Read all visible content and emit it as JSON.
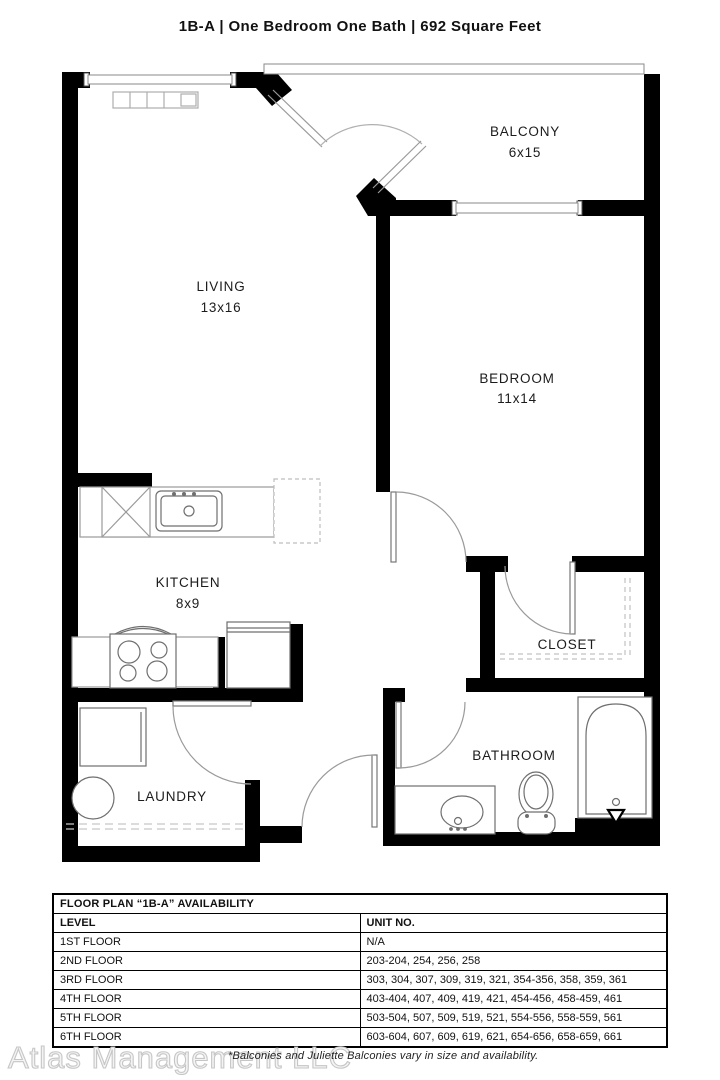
{
  "title": "1B-A  | One Bedroom One Bath |  692 Square Feet",
  "rooms": {
    "balcony": {
      "name": "BALCONY",
      "dims": "6x15"
    },
    "living": {
      "name": "LIVING",
      "dims": "13x16"
    },
    "bedroom": {
      "name": "BEDROOM",
      "dims": "11x14"
    },
    "kitchen": {
      "name": "KITCHEN",
      "dims": "8x9"
    },
    "closet": {
      "name": "CLOSET"
    },
    "laundry": {
      "name": "LAUNDRY"
    },
    "bathroom": {
      "name": "BATHROOM"
    }
  },
  "availability": {
    "title": "FLOOR PLAN “1B-A” AVAILABILITY",
    "columns": {
      "level": "LEVEL",
      "unit": "UNIT NO."
    },
    "rows": [
      {
        "level": "1ST FLOOR",
        "units": "N/A"
      },
      {
        "level": "2ND FLOOR",
        "units": "203-204, 254, 256, 258"
      },
      {
        "level": "3RD FLOOR",
        "units": "303, 304, 307, 309, 319, 321, 354-356, 358, 359, 361"
      },
      {
        "level": "4TH FLOOR",
        "units": "403-404, 407, 409, 419, 421, 454-456, 458-459, 461"
      },
      {
        "level": "5TH FLOOR",
        "units": "503-504, 507, 509, 519, 521, 554-556, 558-559, 561"
      },
      {
        "level": "6TH FLOOR",
        "units": "603-604, 607, 609, 619, 621, 654-656, 658-659, 661"
      }
    ]
  },
  "footer": {
    "watermark": "Atlas Management LLC",
    "note": "*Balconies and Juliette Balconies vary in size and availability."
  },
  "colors": {
    "wall": "#000000",
    "fixture_line": "#7a7a7a",
    "text": "#1a1a1a",
    "watermark": "#c6c6c6"
  }
}
